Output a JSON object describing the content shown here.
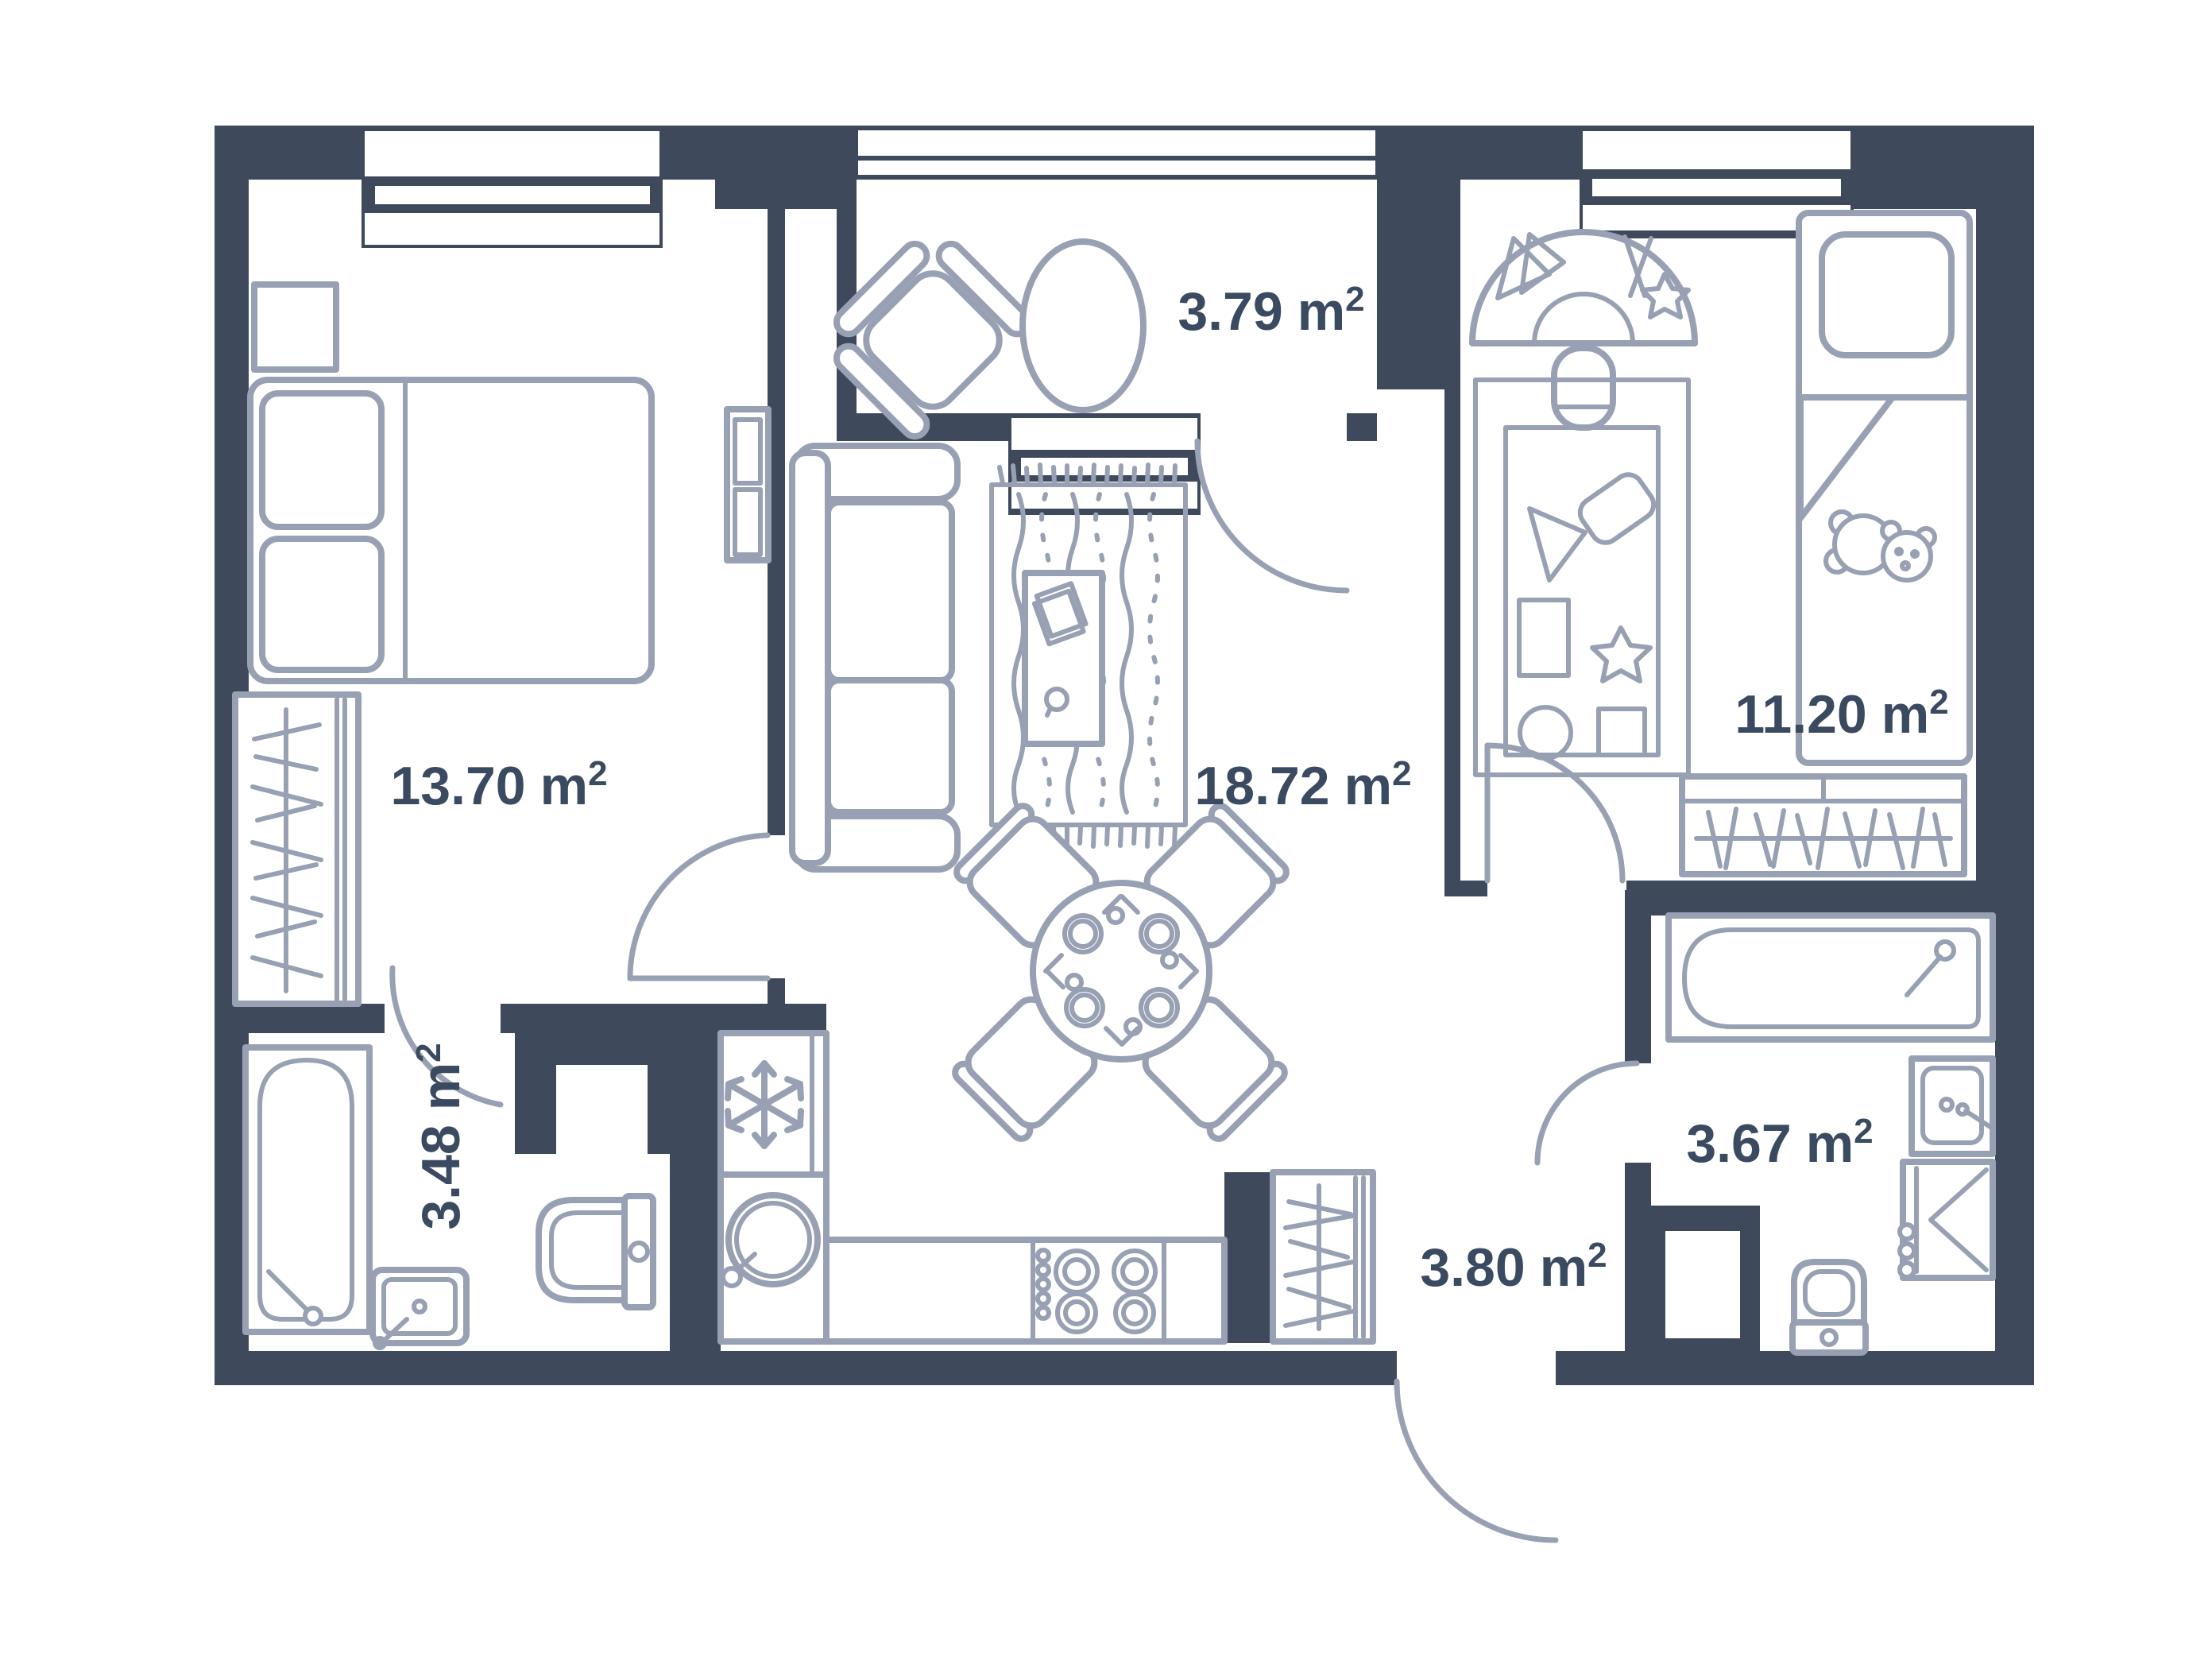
{
  "title": "Two-bedroom apartment floor plan",
  "unit": {
    "symbol": "m",
    "sup": "2"
  },
  "rooms": [
    {
      "id": "bedroom",
      "area": "13.70"
    },
    {
      "id": "balcony",
      "area": "3.79"
    },
    {
      "id": "living-room",
      "area": "18.72"
    },
    {
      "id": "kids-room",
      "area": "11.20"
    },
    {
      "id": "bathroom",
      "area": "3.48"
    },
    {
      "id": "hallway",
      "area": "3.80"
    },
    {
      "id": "bathroom-2",
      "area": "3.67"
    }
  ],
  "colors": {
    "wall": "#3E4A5C",
    "furniture_line": "#97A1B3",
    "label_text": "#3A4A60",
    "background": "#FFFFFF"
  },
  "icons": {
    "fridge": "snowflake-icon",
    "kids_bed": "teddy-bear-icon",
    "wardrobes": "hanger-rail-icon",
    "stove": "four-burners-icon",
    "dining": "plates-and-cutlery-icon"
  }
}
